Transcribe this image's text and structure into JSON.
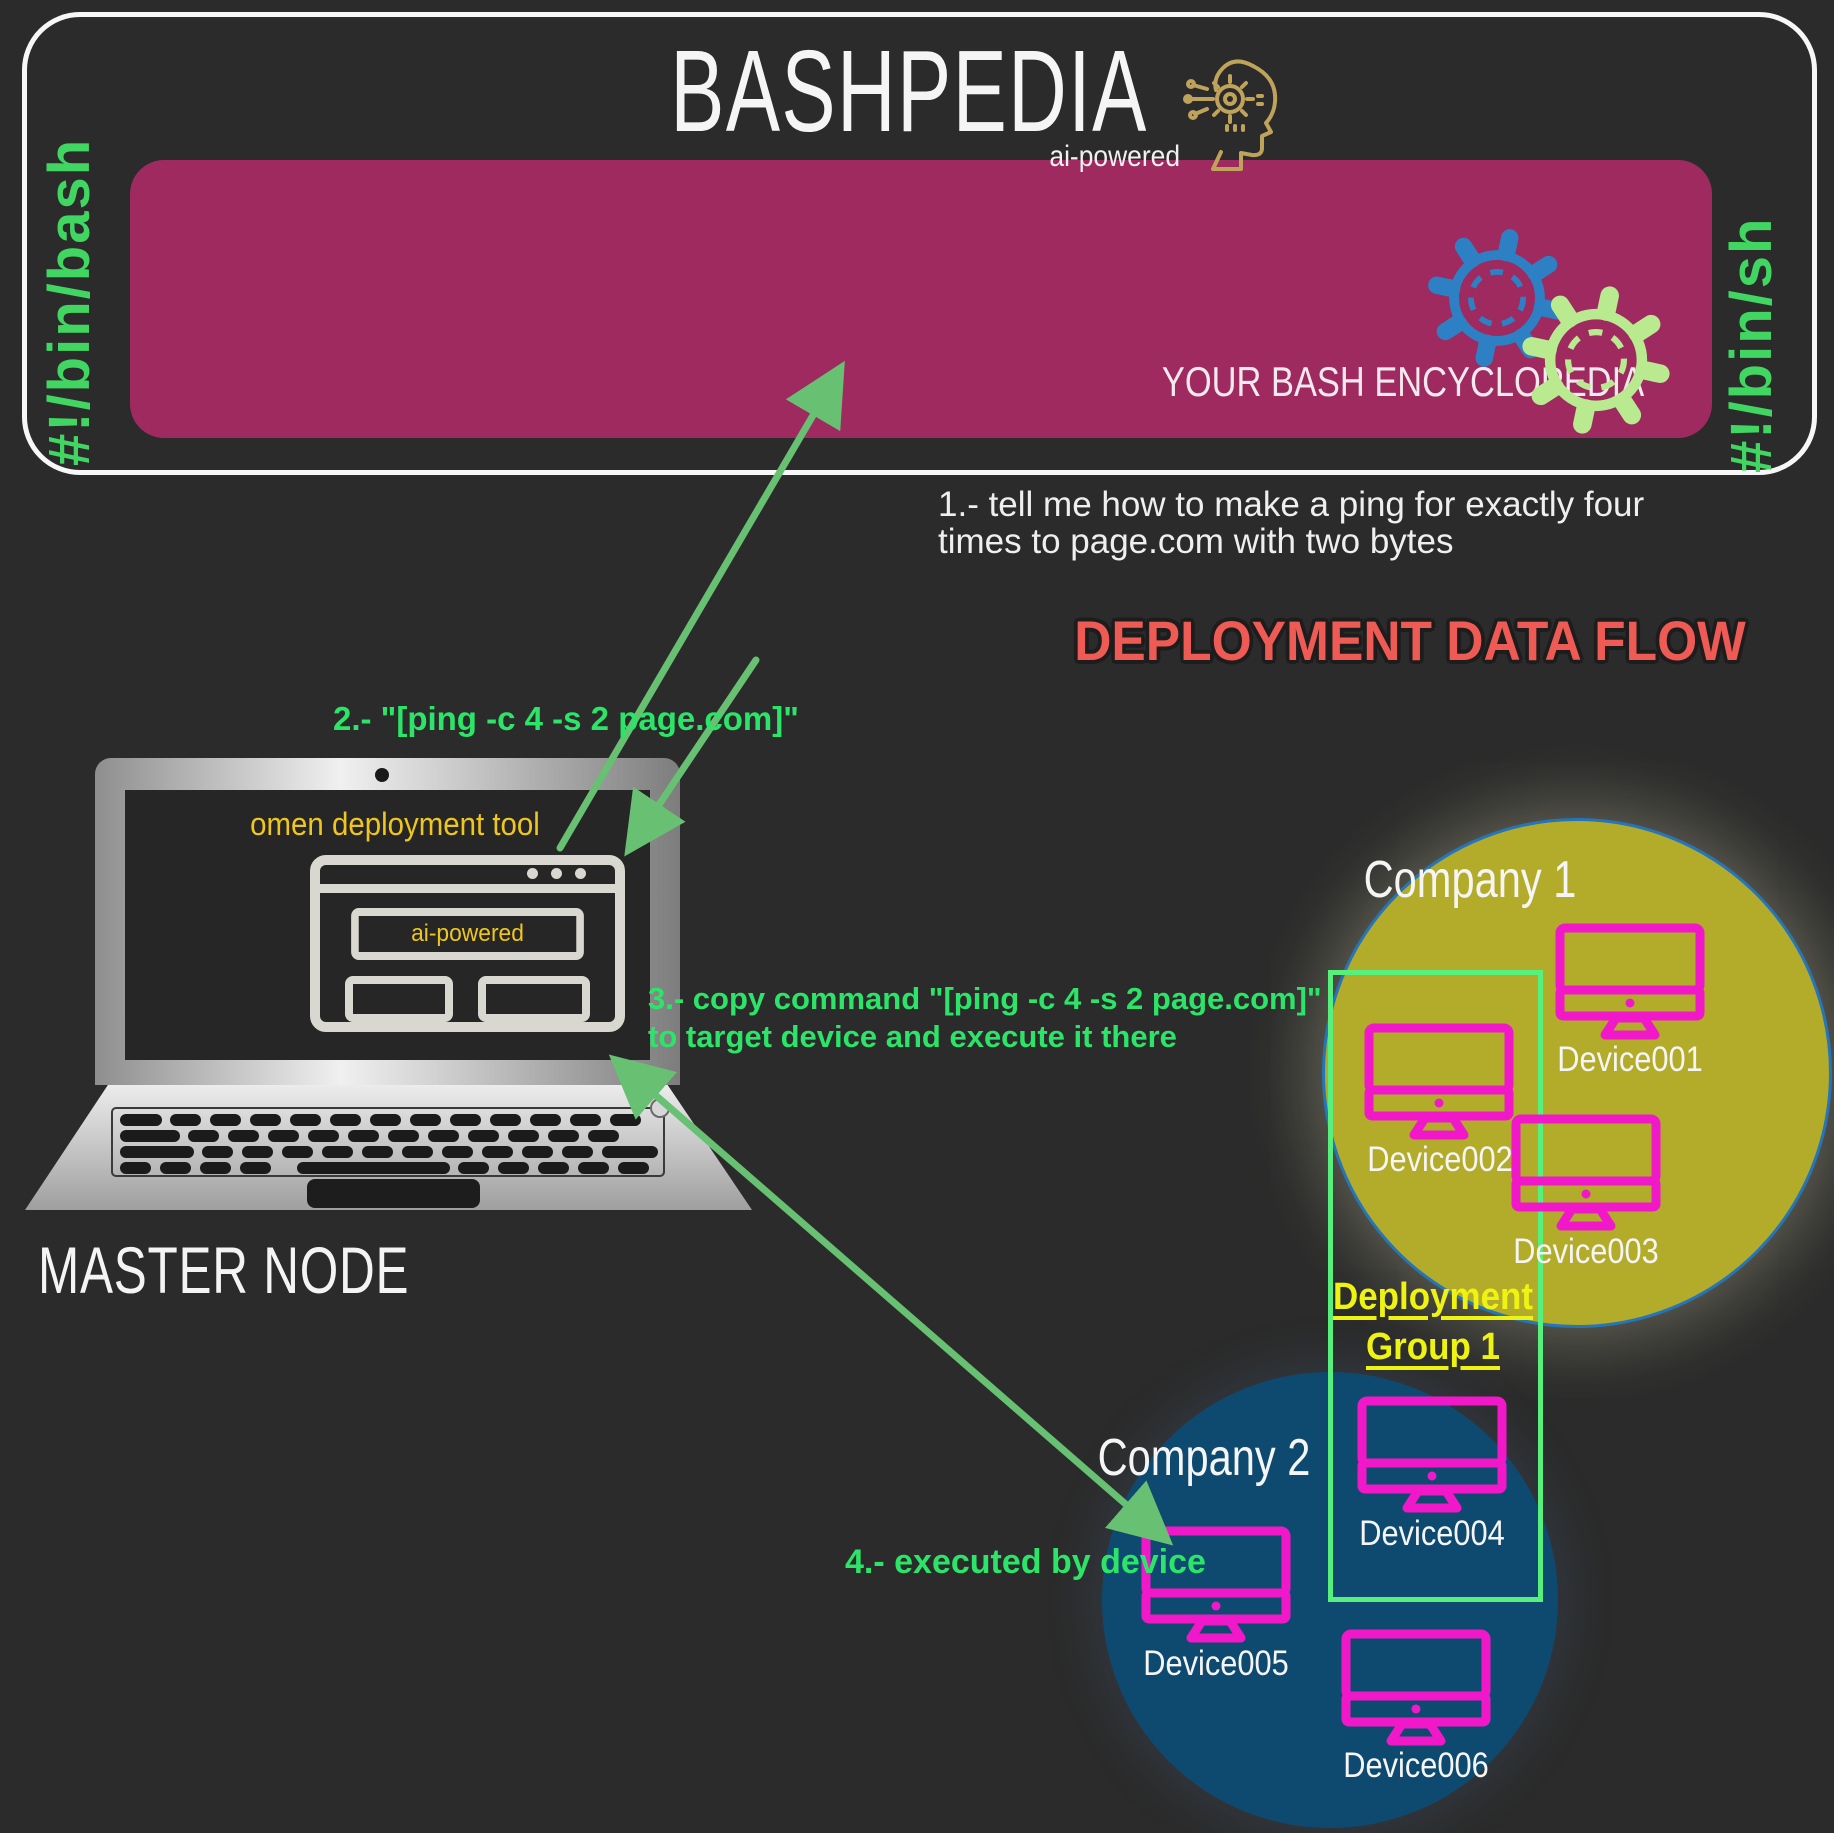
{
  "header": {
    "shebang_left": "#!/bin/bash",
    "shebang_right": "#!/bin/sh",
    "title": "BASHPEDIA",
    "subtitle": "ai-powered",
    "tagline": "YOUR BASH ENCYCLOPEDIA",
    "icons": [
      "ai-head-icon",
      "blue-gear-icon",
      "green-gear-icon"
    ]
  },
  "flow_title": "DEPLOYMENT DATA FLOW",
  "steps": {
    "step1_line1": "1.- tell me how to make a ping for exactly four",
    "step1_line2": "times to page.com with two bytes",
    "step2": "2.- \"[ping -c 4 -s 2 page.com]\"",
    "step3_line1": "3.- copy command \"[ping -c 4 -s 2 page.com]\"",
    "step3_line2": "to target device and execute it there",
    "step4": "4.- executed by device"
  },
  "master_node": {
    "label": "MASTER NODE",
    "app_title": "omen deployment tool",
    "window_badge": "ai-powered"
  },
  "deployment_group": {
    "line1": "Deployment",
    "line2": "Group 1"
  },
  "companies": [
    {
      "name": "Company 1",
      "devices": [
        "Device001",
        "Device002",
        "Device003"
      ],
      "fill": "#b3ab2a"
    },
    {
      "name": "Company 2",
      "devices": [
        "Device004",
        "Device005",
        "Device006"
      ],
      "fill": "#0e4a70"
    }
  ],
  "colors": {
    "background": "#2b2b2b",
    "banner": "#9e2a60",
    "shebang_green": "#41d662",
    "step_green": "#2ce468",
    "arrow_green": "#68c072",
    "flow_title_red": "#ee5a54",
    "monitor_magenta": "#f118c9",
    "group_yellow": "#eff312",
    "group_border_green": "#57f07c",
    "company1_border_blue": "#2575ba",
    "gear_blue": "#2d80c4",
    "gear_green": "#b9ea90",
    "gold_icon": "#bfa35a",
    "omen_yellow": "#eec61d"
  }
}
